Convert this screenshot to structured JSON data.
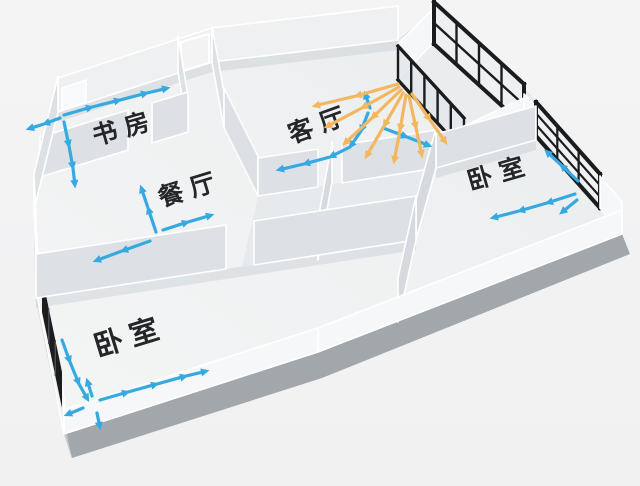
{
  "diagram": {
    "name": "apartment-airflow-floor-plan",
    "background": "#f3f3f4",
    "palette": {
      "cool_air": "#36a9e1",
      "warm_air": "#f2b75f",
      "window_frame": "#1a1c1e",
      "wall": "#ffffff",
      "floor": "#eff1f2",
      "slab_edge": "#a2a7ac"
    },
    "rooms": [
      {
        "id": "study",
        "label": "书房",
        "x": 127,
        "y": 136,
        "rotation": -16,
        "size": 25
      },
      {
        "id": "dining",
        "label": "餐厅",
        "x": 193,
        "y": 197,
        "rotation": -17,
        "size": 25
      },
      {
        "id": "living",
        "label": "客厅",
        "x": 323,
        "y": 132,
        "rotation": -20,
        "size": 25
      },
      {
        "id": "bedroom-east",
        "label": "卧室",
        "x": 502,
        "y": 181,
        "rotation": -16,
        "size": 25
      },
      {
        "id": "bedroom-west",
        "label": "卧室",
        "x": 133,
        "y": 346,
        "rotation": -17,
        "size": 29
      }
    ],
    "features": [
      "entry-door",
      "study-window",
      "balcony-glazing",
      "balcony-mullion-window",
      "bedroom-east-window",
      "bedroom-west-window"
    ],
    "airflow": {
      "legend": {
        "cool": "cool air path",
        "warm": "warm air spread"
      },
      "chains": [
        {
          "name": "study-out-left",
          "kind": "cool",
          "points": [
            [
              60,
              118
            ],
            [
              44,
              124
            ],
            [
              28,
              129
            ]
          ]
        },
        {
          "name": "study-along-wall",
          "kind": "cool",
          "points": [
            [
              64,
              115
            ],
            [
              92,
              107
            ],
            [
              120,
              100
            ],
            [
              147,
              93
            ],
            [
              168,
              88
            ]
          ]
        },
        {
          "name": "study-into-room",
          "kind": "cool",
          "points": [
            [
              64,
              122
            ],
            [
              69,
              146
            ],
            [
              73,
              168
            ],
            [
              75,
              186
            ]
          ]
        },
        {
          "name": "dining-up",
          "kind": "cool",
          "points": [
            [
              156,
              232
            ],
            [
              148,
              208
            ],
            [
              141,
              187
            ]
          ]
        },
        {
          "name": "dining-right",
          "kind": "cool",
          "points": [
            [
              163,
              230
            ],
            [
              188,
              222
            ],
            [
              212,
              215
            ]
          ]
        },
        {
          "name": "dining-down-left",
          "kind": "cool",
          "points": [
            [
              150,
              241
            ],
            [
              122,
              251
            ],
            [
              95,
              261
            ]
          ]
        },
        {
          "name": "living-to-balcony",
          "kind": "cool",
          "points": [
            [
              370,
              108
            ],
            [
              365,
              93
            ]
          ]
        },
        {
          "name": "living-cross-path",
          "kind": "cool",
          "points": [
            [
              368,
              113
            ],
            [
              361,
              131
            ],
            [
              350,
              147
            ],
            [
              330,
              157
            ],
            [
              304,
              164
            ],
            [
              278,
              170
            ]
          ]
        },
        {
          "name": "living-along-balcony",
          "kind": "cool",
          "points": [
            [
              383,
              128
            ],
            [
              407,
              137
            ],
            [
              430,
              146
            ]
          ]
        },
        {
          "name": "living-warm-ray-1",
          "kind": "warm",
          "points": [
            [
              398,
              84
            ],
            [
              356,
              96
            ],
            [
              314,
              106
            ]
          ]
        },
        {
          "name": "living-warm-ray-2",
          "kind": "warm",
          "points": [
            [
              399,
              87
            ],
            [
              362,
              108
            ],
            [
              326,
              127
            ]
          ]
        },
        {
          "name": "living-warm-ray-3",
          "kind": "warm",
          "points": [
            [
              401,
              90
            ],
            [
              372,
              118
            ],
            [
              344,
              144
            ]
          ]
        },
        {
          "name": "living-warm-ray-4",
          "kind": "warm",
          "points": [
            [
              403,
              93
            ],
            [
              384,
              126
            ],
            [
              366,
              157
            ]
          ]
        },
        {
          "name": "living-warm-ray-5",
          "kind": "warm",
          "points": [
            [
              406,
              95
            ],
            [
              400,
              130
            ],
            [
              394,
              162
            ]
          ]
        },
        {
          "name": "living-warm-ray-6",
          "kind": "warm",
          "points": [
            [
              409,
              96
            ],
            [
              416,
              128
            ],
            [
              422,
              156
            ]
          ]
        },
        {
          "name": "living-warm-ray-7",
          "kind": "warm",
          "points": [
            [
              412,
              94
            ],
            [
              430,
              120
            ],
            [
              446,
              143
            ]
          ]
        },
        {
          "name": "bedroom-east-left",
          "kind": "cool",
          "points": [
            [
              575,
              194
            ],
            [
              547,
              203
            ],
            [
              519,
              211
            ],
            [
              492,
              218
            ]
          ]
        },
        {
          "name": "bedroom-east-up",
          "kind": "cool",
          "points": [
            [
              578,
              181
            ],
            [
              561,
              165
            ],
            [
              546,
              151
            ]
          ]
        },
        {
          "name": "bedroom-east-down",
          "kind": "cool",
          "points": [
            [
              577,
              200
            ],
            [
              561,
              213
            ]
          ]
        },
        {
          "name": "bedroom-west-along-wall",
          "kind": "cool",
          "points": [
            [
              62,
              340
            ],
            [
              70,
              362
            ],
            [
              79,
              384
            ],
            [
              88,
              400
            ]
          ]
        },
        {
          "name": "bedroom-west-into-room",
          "kind": "cool",
          "points": [
            [
              100,
              400
            ],
            [
              128,
              392
            ],
            [
              157,
              384
            ],
            [
              186,
              376
            ],
            [
              207,
              371
            ]
          ]
        },
        {
          "name": "bedroom-west-up",
          "kind": "cool",
          "points": [
            [
              92,
              396
            ],
            [
              87,
              380
            ]
          ]
        },
        {
          "name": "bedroom-west-down",
          "kind": "cool",
          "points": [
            [
              97,
              413
            ],
            [
              100,
              428
            ]
          ]
        },
        {
          "name": "bedroom-west-out",
          "kind": "cool",
          "points": [
            [
              83,
              408
            ],
            [
              66,
              415
            ]
          ]
        }
      ]
    }
  }
}
